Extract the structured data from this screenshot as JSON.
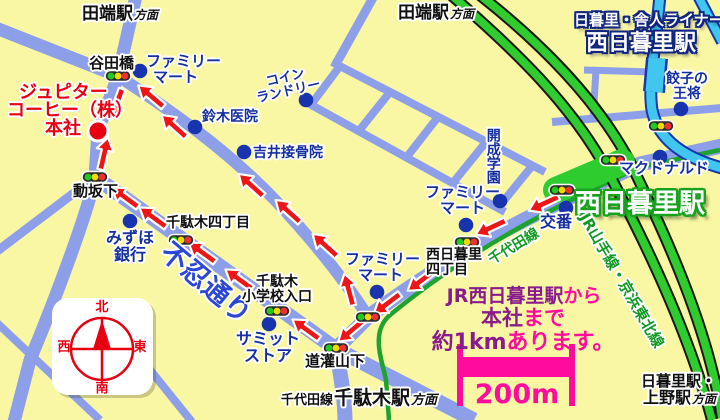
{
  "map": {
    "company": {
      "line1": "ジュピター",
      "line2": "コーヒー（株）",
      "line3": "本社"
    },
    "stations": {
      "toneri_liner": "日暮里・舎人ライナー",
      "nishi_nippori": "西日暮里駅"
    },
    "directions": {
      "tabata": "田端駅",
      "tabata_suffix": "方面",
      "sendagi_prefix": "千代田線",
      "sendagi_station": "千駄木駅",
      "sendagi_suffix": "方面",
      "nippori_line1": "日暮里駅・",
      "nippori_line2": "上野駅",
      "nippori_suffix": "方面"
    },
    "rail_labels": {
      "jr_lines": "JR山手線・京浜東北線",
      "chiyoda_line": "千代田線"
    },
    "roads": {
      "shinobazu": "不忍通り"
    },
    "intersections": {
      "yatabashi": "谷田橋",
      "dosakashita": "動坂下",
      "sendagi4": "千駄木四丁目",
      "elem1": "千駄木",
      "elem2": "小学校入口",
      "dokanyamashita": "道灌山下",
      "nishinippori4_1": "西日暮里",
      "nishinippori4_2": "四丁目"
    },
    "landmarks": {
      "familymart_1": "ファミリー",
      "familymart_2": "マート",
      "coin_1": "コイン",
      "coin_2": "ランドリー",
      "suzuki": "鈴木医院",
      "yoshii": "吉井接骨院",
      "mizuho_1": "みずほ",
      "mizuho_2": "銀行",
      "summit_1": "サミット",
      "summit_2": "ストア",
      "kaisei": "開成学園",
      "koban": "交番",
      "mcdonalds": "マクドナルド",
      "gyoza_1": "餃子の",
      "gyoza_2": "王将"
    },
    "note": {
      "seg1": "JR西日暮里駅",
      "seg2": "から",
      "seg3": "本社",
      "seg4": "まで",
      "seg5": "約1km",
      "seg6": "あります。"
    },
    "scale": {
      "label": "200m"
    },
    "compass": {
      "north": "北",
      "south": "南",
      "east": "東",
      "west": "西"
    },
    "colors": {
      "background": "#FAF7A4",
      "road": "#8D9FE9",
      "jr_green": "#2ECC2E",
      "liner_cyan": "#41C7EF",
      "route_red": "#ED1515",
      "navy_text": "#16309F",
      "note_purple": "#8A1B8D",
      "note_pink": "#FF0C9C",
      "company_red": "#E60012"
    }
  }
}
